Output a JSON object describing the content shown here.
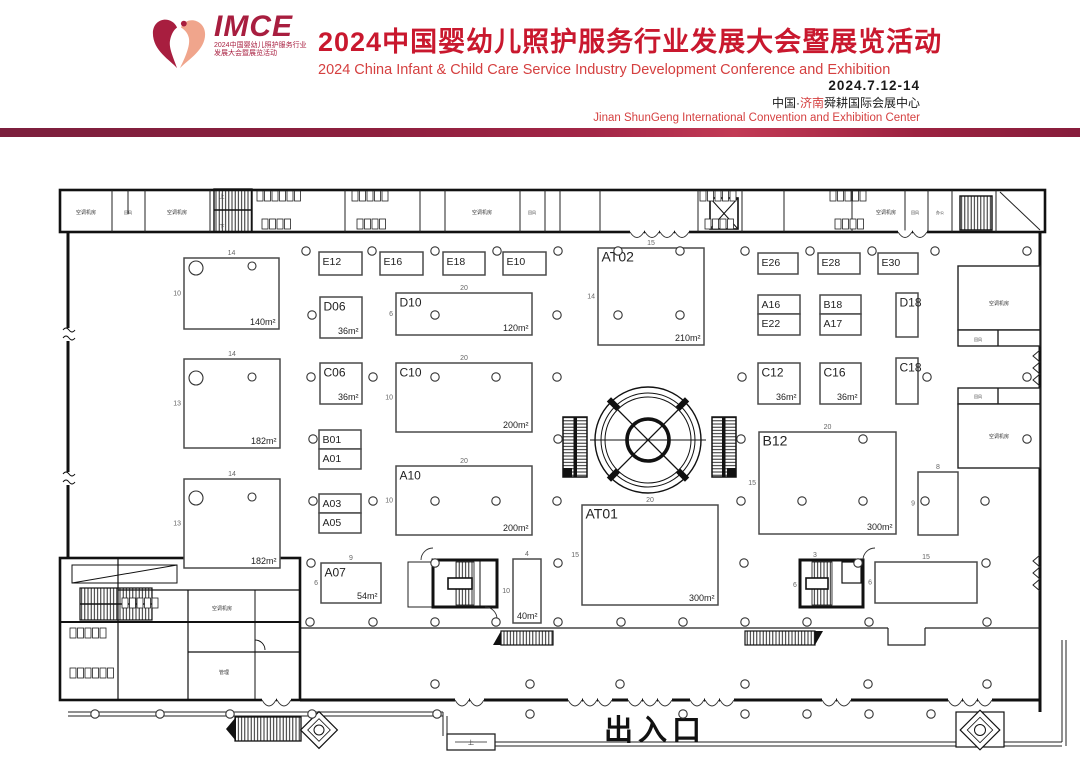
{
  "header": {
    "logo": {
      "acronym": "IMCE",
      "tagline1": "2024中国婴幼儿照护服务行业",
      "tagline2": "发展大会暨展览活动"
    },
    "title_cn": "2024中国婴幼儿照护服务行业发展大会暨展览活动",
    "title_en": "2024 China Infant & Child Care Service Industry Development Conference and Exhibition",
    "date": "2024.7.12-14",
    "venue": {
      "prefix": "中国·",
      "city": "济南",
      "suffix": "舜耕国际会展中心"
    },
    "venue_en": "Jinan ShunGeng International Convention and Exhibition Center",
    "accent_color": "#c9182e"
  },
  "floorplan": {
    "entrance_label": "出入口",
    "booths": [
      {
        "id": "",
        "area": "140m²",
        "x": 184,
        "y": 258,
        "w": 95,
        "h": 71,
        "dt": "14",
        "dl": "10"
      },
      {
        "id": "",
        "area": "182m²",
        "x": 184,
        "y": 359,
        "w": 96,
        "h": 89,
        "dt": "14",
        "dl": "13"
      },
      {
        "id": "",
        "area": "182m²",
        "x": 184,
        "y": 479,
        "w": 96,
        "h": 89,
        "dt": "14",
        "dl": "13"
      },
      {
        "id": "E12",
        "x": 319,
        "y": 252,
        "w": 43,
        "h": 23
      },
      {
        "id": "E16",
        "x": 380,
        "y": 252,
        "w": 43,
        "h": 23
      },
      {
        "id": "E18",
        "x": 443,
        "y": 252,
        "w": 42,
        "h": 23
      },
      {
        "id": "E10",
        "x": 503,
        "y": 252,
        "w": 43,
        "h": 23
      },
      {
        "id": "AT02",
        "area": "210m²",
        "x": 598,
        "y": 248,
        "w": 106,
        "h": 97,
        "dt": "15",
        "dl": "14"
      },
      {
        "id": "E26",
        "x": 758,
        "y": 253,
        "w": 40,
        "h": 21
      },
      {
        "id": "E28",
        "x": 818,
        "y": 253,
        "w": 42,
        "h": 21
      },
      {
        "id": "E30",
        "x": 878,
        "y": 253,
        "w": 40,
        "h": 21
      },
      {
        "id": "D06",
        "area": "36m²",
        "x": 320,
        "y": 297,
        "w": 42,
        "h": 41
      },
      {
        "id": "D10",
        "area": "120m²",
        "x": 396,
        "y": 293,
        "w": 136,
        "h": 42,
        "dt": "20",
        "dl": "6"
      },
      {
        "id": "A16",
        "x": 758,
        "y": 295,
        "w": 42,
        "h": 19
      },
      {
        "id": "E22",
        "x": 758,
        "y": 314,
        "w": 42,
        "h": 21
      },
      {
        "id": "B18",
        "x": 820,
        "y": 295,
        "w": 41,
        "h": 19
      },
      {
        "id": "A17",
        "x": 820,
        "y": 314,
        "w": 41,
        "h": 21
      },
      {
        "id": "D18",
        "x": 896,
        "y": 293,
        "w": 22,
        "h": 44
      },
      {
        "id": "C06",
        "area": "36m²",
        "x": 320,
        "y": 363,
        "w": 42,
        "h": 41
      },
      {
        "id": "C10",
        "area": "200m²",
        "x": 396,
        "y": 363,
        "w": 136,
        "h": 69,
        "dt": "20",
        "dl": "10"
      },
      {
        "id": "C12",
        "area": "36m²",
        "x": 758,
        "y": 363,
        "w": 42,
        "h": 41
      },
      {
        "id": "C16",
        "area": "36m²",
        "x": 820,
        "y": 363,
        "w": 41,
        "h": 41
      },
      {
        "id": "C18",
        "x": 896,
        "y": 358,
        "w": 22,
        "h": 46
      },
      {
        "id": "B01",
        "x": 319,
        "y": 430,
        "w": 42,
        "h": 19
      },
      {
        "id": "A01",
        "x": 319,
        "y": 449,
        "w": 42,
        "h": 20
      },
      {
        "id": "B12",
        "area": "300m²",
        "x": 759,
        "y": 432,
        "w": 137,
        "h": 102,
        "dt": "20",
        "dl": "15"
      },
      {
        "id": "A03",
        "x": 319,
        "y": 494,
        "w": 42,
        "h": 19
      },
      {
        "id": "A05",
        "x": 319,
        "y": 513,
        "w": 42,
        "h": 20
      },
      {
        "id": "A10",
        "area": "200m²",
        "x": 396,
        "y": 466,
        "w": 136,
        "h": 69,
        "dt": "20",
        "dl": "10"
      },
      {
        "id": "",
        "x": 918,
        "y": 472,
        "w": 40,
        "h": 63,
        "dt": "8",
        "dl": "9"
      },
      {
        "id": "AT01",
        "area": "300m²",
        "x": 582,
        "y": 505,
        "w": 136,
        "h": 100,
        "dt": "20",
        "dl": "15"
      },
      {
        "id": "A07",
        "area": "54m²",
        "x": 321,
        "y": 563,
        "w": 60,
        "h": 40,
        "dt": "9",
        "dl": "6"
      },
      {
        "id": "",
        "area": "40m²",
        "x": 513,
        "y": 559,
        "w": 28,
        "h": 64,
        "dt": "4",
        "dl": "10"
      },
      {
        "id": "",
        "x": 875,
        "y": 562,
        "w": 102,
        "h": 41,
        "dt": "15",
        "dl": "6"
      }
    ],
    "room_labels": [
      {
        "t": "空调机房",
        "x": 86,
        "y": 214,
        "fs": 5
      },
      {
        "t": "回风",
        "x": 128,
        "y": 214,
        "fs": 4
      },
      {
        "t": "空调机房",
        "x": 177,
        "y": 214,
        "fs": 5
      },
      {
        "t": "空调机房",
        "x": 482,
        "y": 214,
        "fs": 5
      },
      {
        "t": "回风",
        "x": 532,
        "y": 214,
        "fs": 4
      },
      {
        "t": "空调机房",
        "x": 886,
        "y": 214,
        "fs": 5
      },
      {
        "t": "回风",
        "x": 915,
        "y": 214,
        "fs": 4
      },
      {
        "t": "办公",
        "x": 940,
        "y": 214,
        "fs": 4
      },
      {
        "t": "空调机房",
        "x": 999,
        "y": 305,
        "fs": 5
      },
      {
        "t": "回风",
        "x": 978,
        "y": 341,
        "fs": 4
      },
      {
        "t": "回风",
        "x": 978,
        "y": 398,
        "fs": 4
      },
      {
        "t": "空调机房",
        "x": 999,
        "y": 438,
        "fs": 5
      },
      {
        "t": "空调机房",
        "x": 222,
        "y": 610,
        "fs": 5
      },
      {
        "t": "管理",
        "x": 224,
        "y": 674,
        "fs": 5
      },
      {
        "t": "上",
        "x": 471,
        "y": 745,
        "fs": 6
      },
      {
        "t": "上",
        "x": 222,
        "y": 198,
        "fs": 5
      },
      {
        "t": "下",
        "x": 222,
        "y": 228,
        "fs": 5
      }
    ],
    "stair_dims": [
      {
        "t": "3",
        "x": 815,
        "y": 557
      },
      {
        "t": "6",
        "x": 795,
        "y": 587
      }
    ],
    "stalls": [
      {
        "x": 257,
        "y": 191,
        "n": 6
      },
      {
        "x": 352,
        "y": 191,
        "n": 5
      },
      {
        "x": 262,
        "y": 219,
        "n": 4
      },
      {
        "x": 357,
        "y": 219,
        "n": 4
      },
      {
        "x": 700,
        "y": 191,
        "n": 5
      },
      {
        "x": 830,
        "y": 191,
        "n": 5
      },
      {
        "x": 705,
        "y": 219,
        "n": 4
      },
      {
        "x": 835,
        "y": 219,
        "n": 4
      },
      {
        "x": 70,
        "y": 628,
        "n": 5
      },
      {
        "x": 70,
        "y": 668,
        "n": 6
      },
      {
        "x": 122,
        "y": 598,
        "n": 5
      }
    ],
    "columns": [
      {
        "y": 251,
        "xs": [
          306,
          372,
          435,
          497,
          558,
          618,
          680,
          745,
          810,
          872,
          935,
          1027
        ]
      },
      {
        "y": 315,
        "xs": [
          312,
          435,
          557,
          618,
          680
        ]
      },
      {
        "y": 377,
        "xs": [
          311,
          373,
          435,
          496,
          557,
          742,
          927,
          1027
        ]
      },
      {
        "y": 439,
        "xs": [
          313,
          558,
          741,
          863,
          1027
        ]
      },
      {
        "y": 501,
        "xs": [
          313,
          373,
          435,
          496,
          557,
          741,
          802,
          863,
          925,
          985
        ]
      },
      {
        "y": 563,
        "xs": [
          311,
          435,
          558,
          744,
          858,
          986
        ]
      },
      {
        "y": 622,
        "xs": [
          310,
          373,
          435,
          496,
          558,
          621,
          683,
          745,
          807,
          869,
          987
        ]
      },
      {
        "y": 684,
        "xs": [
          435,
          530,
          620,
          745,
          868,
          987
        ]
      },
      {
        "y": 714,
        "xs": [
          95,
          160,
          230,
          312,
          437,
          530,
          683,
          745,
          807,
          869,
          931
        ]
      }
    ],
    "big_columns": [
      {
        "x": 196,
        "y": 268,
        "r": 7
      },
      {
        "x": 252,
        "y": 266,
        "r": 4
      },
      {
        "x": 196,
        "y": 378,
        "r": 7
      },
      {
        "x": 252,
        "y": 377,
        "r": 4
      },
      {
        "x": 196,
        "y": 498,
        "r": 7
      },
      {
        "x": 252,
        "y": 497,
        "r": 4
      }
    ],
    "doors": [
      {
        "x": 262,
        "n": 2
      },
      {
        "x": 455,
        "n": 2
      },
      {
        "x": 568,
        "n": 3
      },
      {
        "x": 628,
        "n": 3
      },
      {
        "x": 690,
        "n": 3
      },
      {
        "x": 822,
        "n": 2
      },
      {
        "x": 948,
        "n": 3
      }
    ],
    "top_doors": [
      {
        "x": 630,
        "n": 4
      },
      {
        "x": 898,
        "n": 2
      }
    ]
  }
}
